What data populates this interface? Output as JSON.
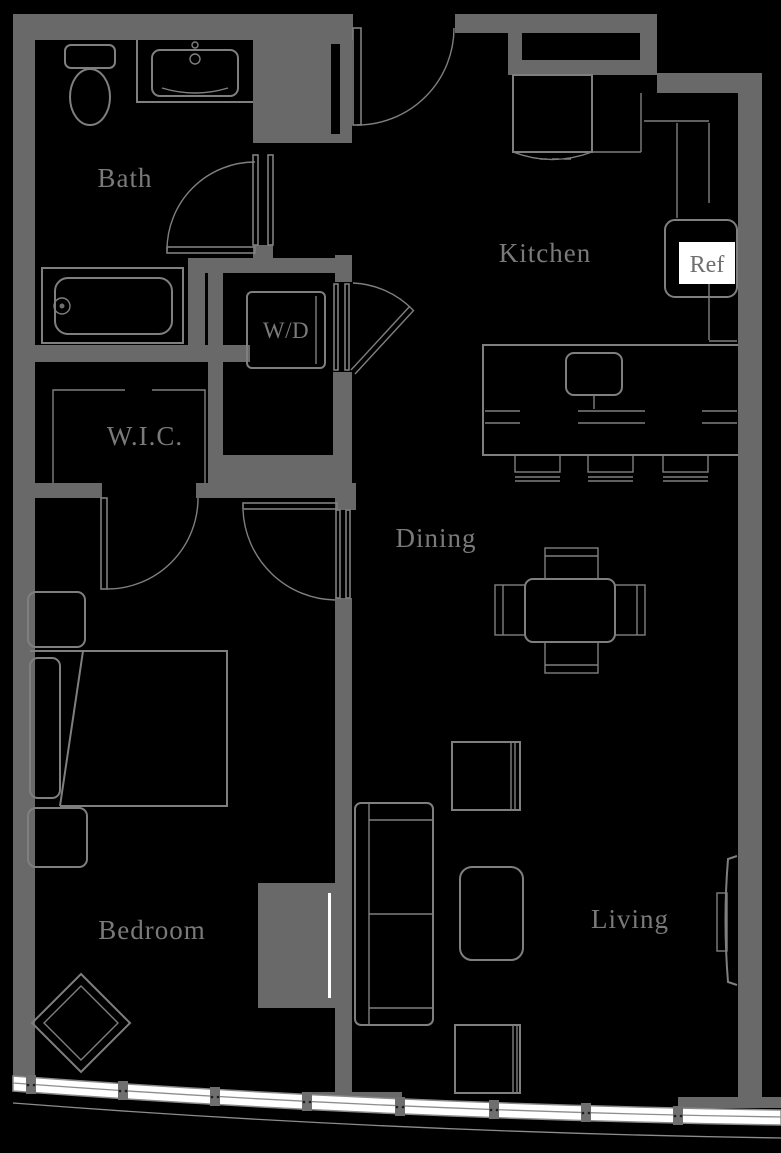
{
  "colors": {
    "background": "#000000",
    "wall": "#696969",
    "line": "#7f7f7f",
    "label": "#7a7a7a",
    "glass": "#ffffff",
    "ref_box": "#ffffff",
    "ref_text": "#6f6f6f"
  },
  "labels": {
    "bath": "Bath",
    "kitchen": "Kitchen",
    "ref": "Ref",
    "wd": "W/D",
    "wic": "W.I.C.",
    "dining": "Dining",
    "bedroom": "Bedroom",
    "living": "Living"
  }
}
